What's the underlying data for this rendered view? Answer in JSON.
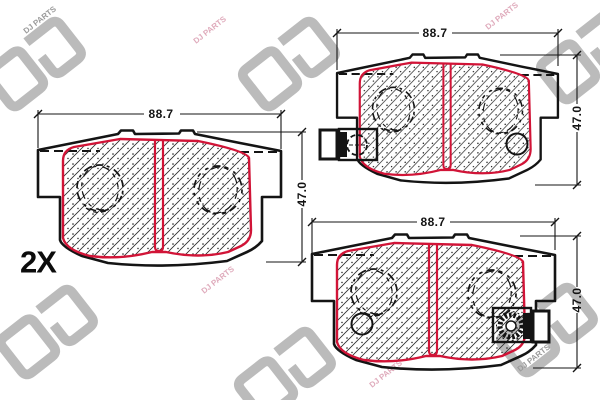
{
  "brand": {
    "logo_letters": "DJ",
    "watermark_text": "DJ PARTS"
  },
  "quantity_label": "2X",
  "views": {
    "left_pad": {
      "width_mm": "88.7",
      "height_mm": "47.0"
    },
    "top_right_pad": {
      "width_mm": "88.7",
      "height_mm": "47.0"
    },
    "bottom_right_pad": {
      "width_mm": "88.7",
      "height_mm": "47.0"
    }
  },
  "colors": {
    "line": "#141414",
    "friction_outline": "#d11437",
    "watermark_gray": "#a0a0a0",
    "watermark_pink": "#dfaabb",
    "background": "#ffffff"
  }
}
